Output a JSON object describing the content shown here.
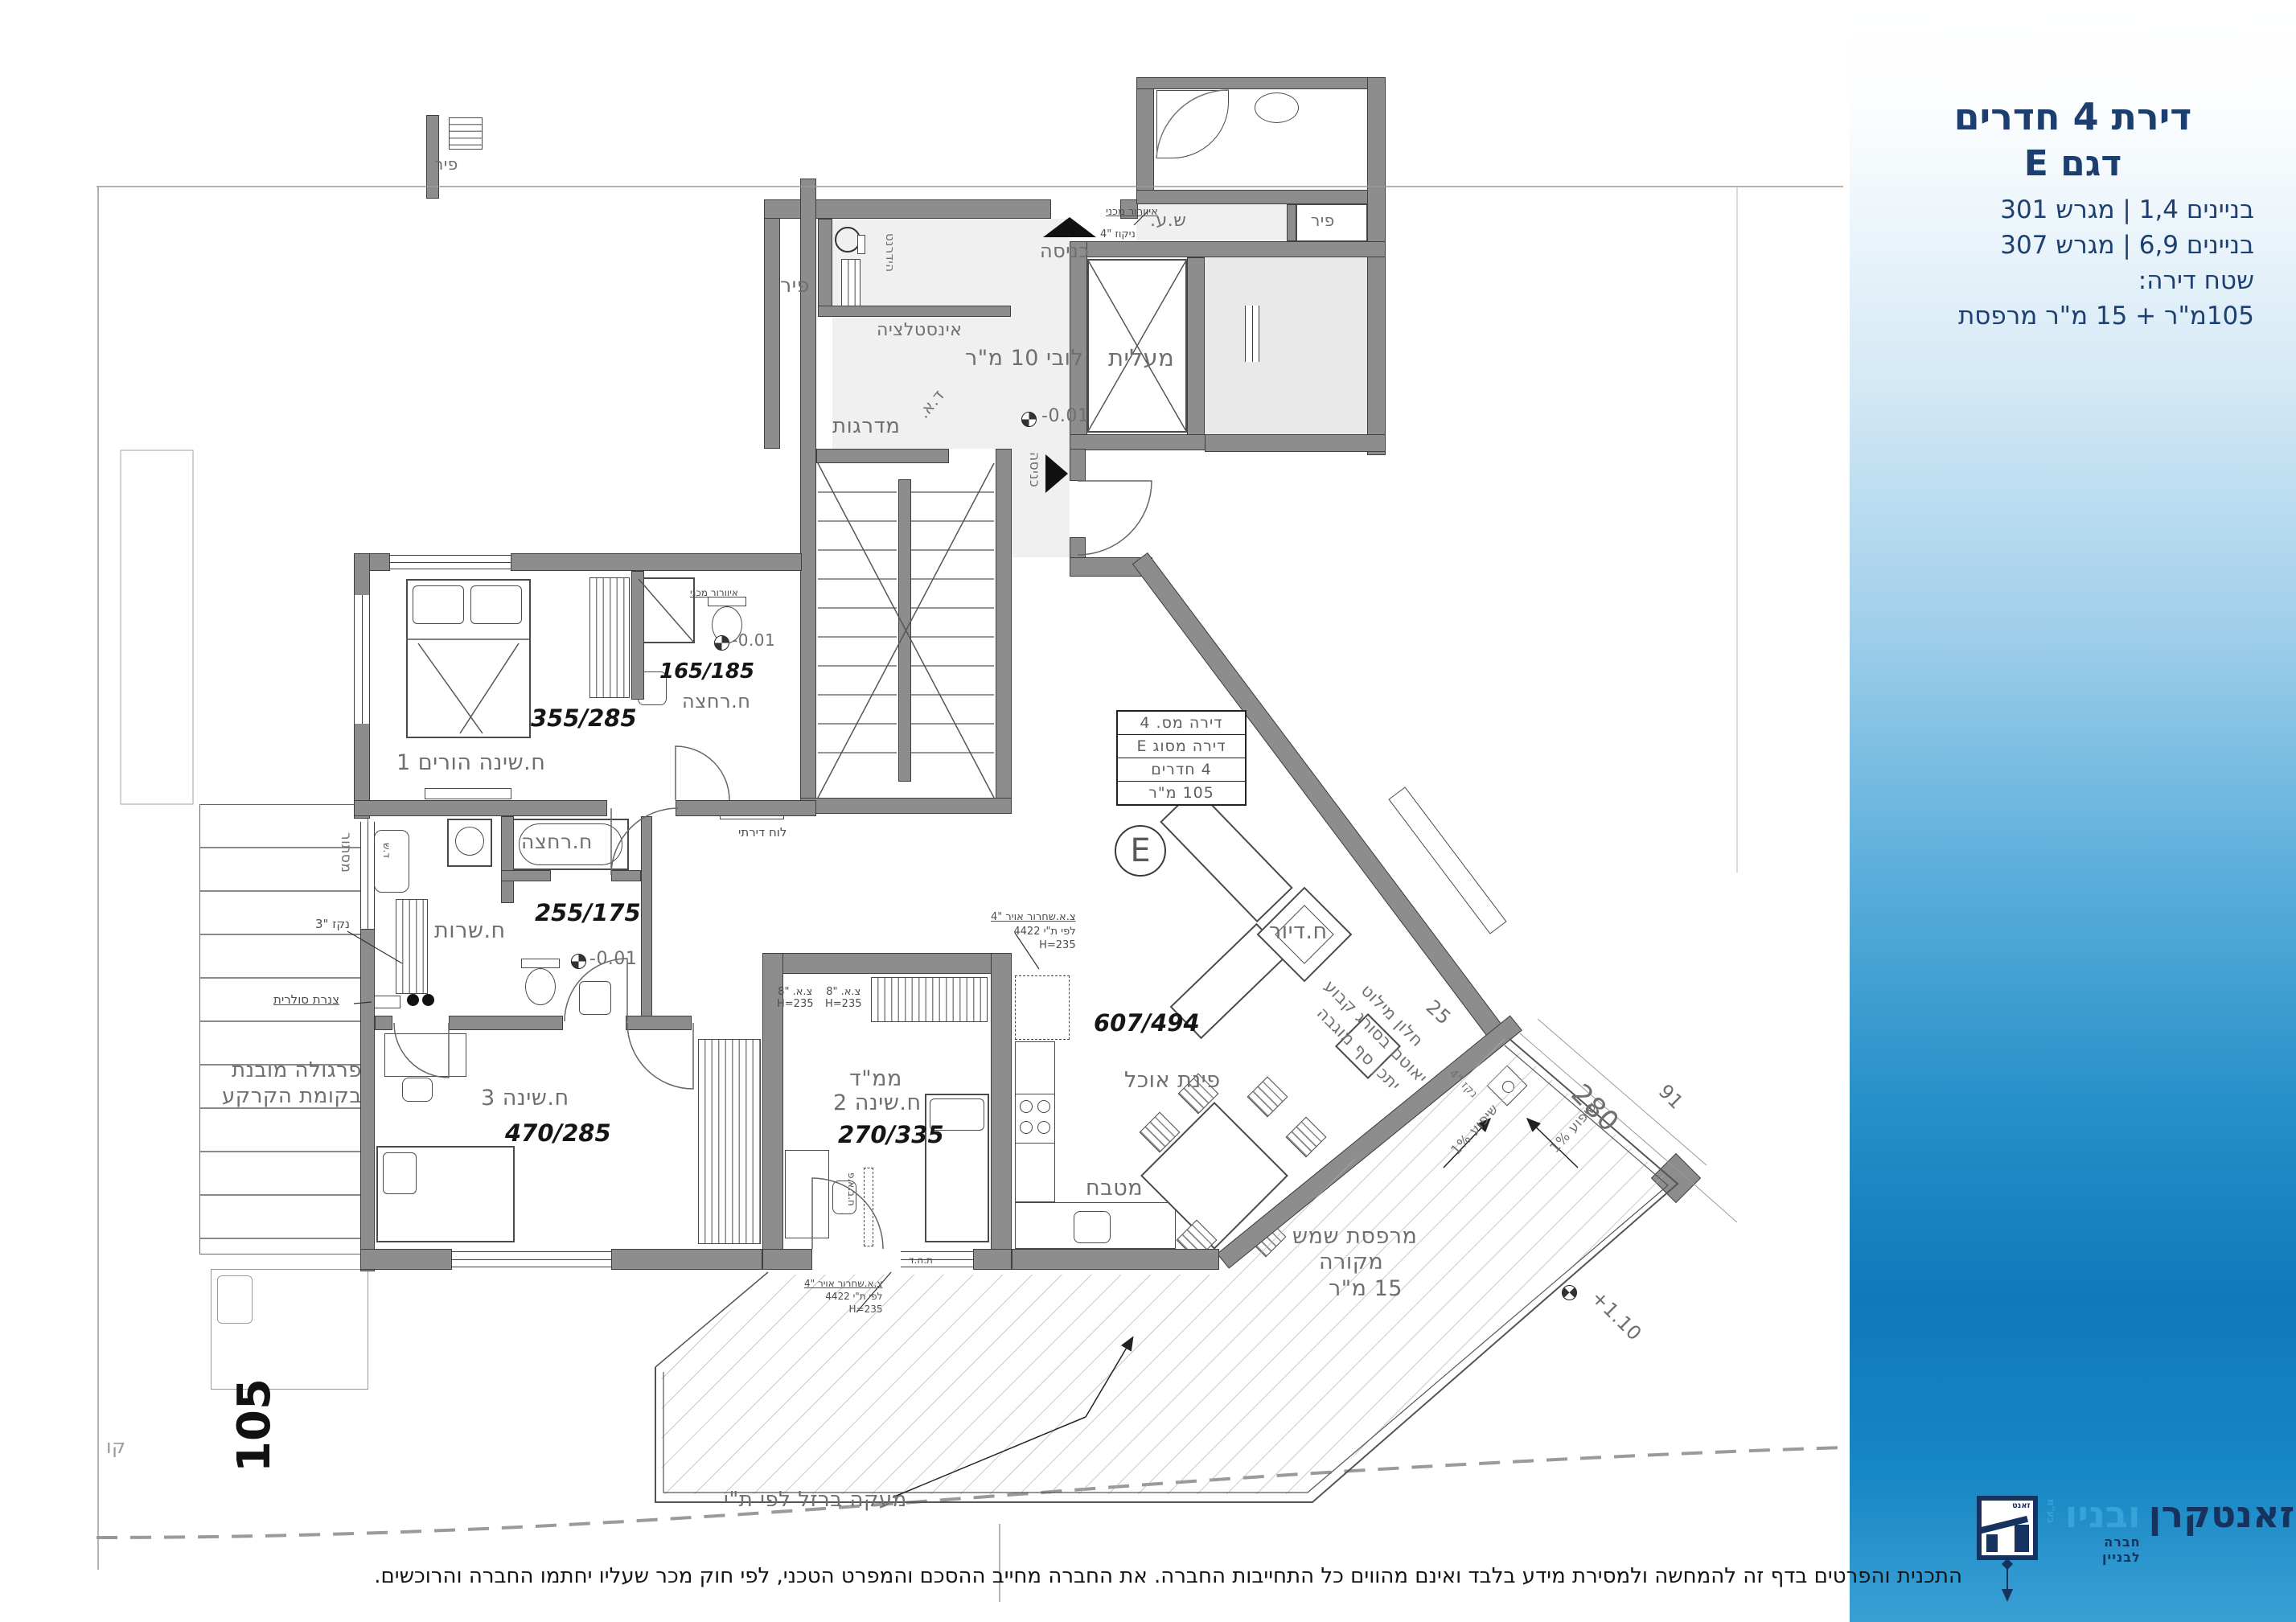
{
  "sidebar": {
    "title_line1": "דירת 4 חדרים",
    "title_line2": "דגם E",
    "line1": "בניינים 1,4    |    מגרש 301",
    "line2": "בניינים 6,9    |    מגרש 307",
    "line3": "שטח דירה:",
    "line4": "105מ\"ר + 15 מ\"ר מרפסת"
  },
  "footer": {
    "disclaimer": "התכנית והפרטים בדף זה להמחשה ולמסירת מידע בלבד ואינם מהווים כל התחייבות החברה. את החברה מחייב ההסכם והמפרט הטכני, לפי חוק מכר שעליו יחתמו החברה והרוכשים.",
    "logo": {
      "name_main": "זאנטקרן",
      "name_sub": "ובניו",
      "suffix": "בע\"מ",
      "tagline": "חברה לבניין",
      "emblem_text": "זאנט"
    }
  },
  "plan": {
    "entrance_label": "כניסה",
    "drain_note": "ניקוז \"4",
    "mech_vent": "איוורור מכני",
    "lobby": "לובי 10 מ\"ר",
    "elevator": "מעלית",
    "stairs": "מדרגות",
    "shaft": "פיר",
    "service_shaft": "ש.ע.",
    "hydrant": "הידרנט",
    "installation": "אינסטלציה",
    "door_abbr": "ד.א.",
    "level_marker": "-0.01",
    "apartment_panel": "לוח דירתי",
    "master_bedroom": "ח.שינה הורים 1",
    "master_dim": "355/285",
    "bathroom": "ח.רחצה",
    "bath1_dim": "165/185",
    "bath2_dim": "255/175",
    "service_room": "ח.שרות",
    "bedroom3": "ח.שינה 3",
    "bedroom3_dim": "470/285",
    "mamad": "ממ\"ד",
    "bedroom2": "ח.שינה 2",
    "bedroom2_dim": "270/335",
    "kitchen": "מטבח",
    "dining": "פינת אוכל",
    "living": "ח.דיור",
    "living_dim": "607/494",
    "balcony_l1": "מרפסת שמש",
    "balcony_l2": "מקורה",
    "balcony_l3": "15 מ\"ר",
    "railing_note": "מעקה ברזל לפי ת\"י",
    "escape_l1": "חלון מילוט",
    "escape_l2": "יאוטם בסורג קבוע",
    "escape_l3": "יתכן סף מוגבה",
    "slope_label": "שיפוע 1%",
    "drain_roof": "נקז \"4",
    "drain3": "נקז \"3",
    "solar_pipes": "צנרת סולרית",
    "water_heater": "ד.ש",
    "mistor": "מסתור",
    "pergola_l1": "פרגולה מובנת",
    "pergola_l2": "בקומת הקרקע",
    "dim_280": "280",
    "dim_91": "91",
    "dim_25": "25",
    "level_110": "+1.10",
    "plot_105": "105",
    "kav_label": "קו",
    "ac_vent": "צ.א. \"8",
    "ac_h": "H=235",
    "air_release_l1": "צ.א.שחרור אויר \"4",
    "air_release_l2": "לפי ת\"י 4422",
    "air_release_l3": "H=235",
    "thd": "ת.ה.ד",
    "hbap": "ח.ב.א.פ",
    "info_table": {
      "r1": "דירה מס. 4",
      "r2": "דירה מסוג E",
      "r3": "4 חדרים",
      "r4": "105 מ\"ר"
    },
    "unit_letter": "E"
  }
}
